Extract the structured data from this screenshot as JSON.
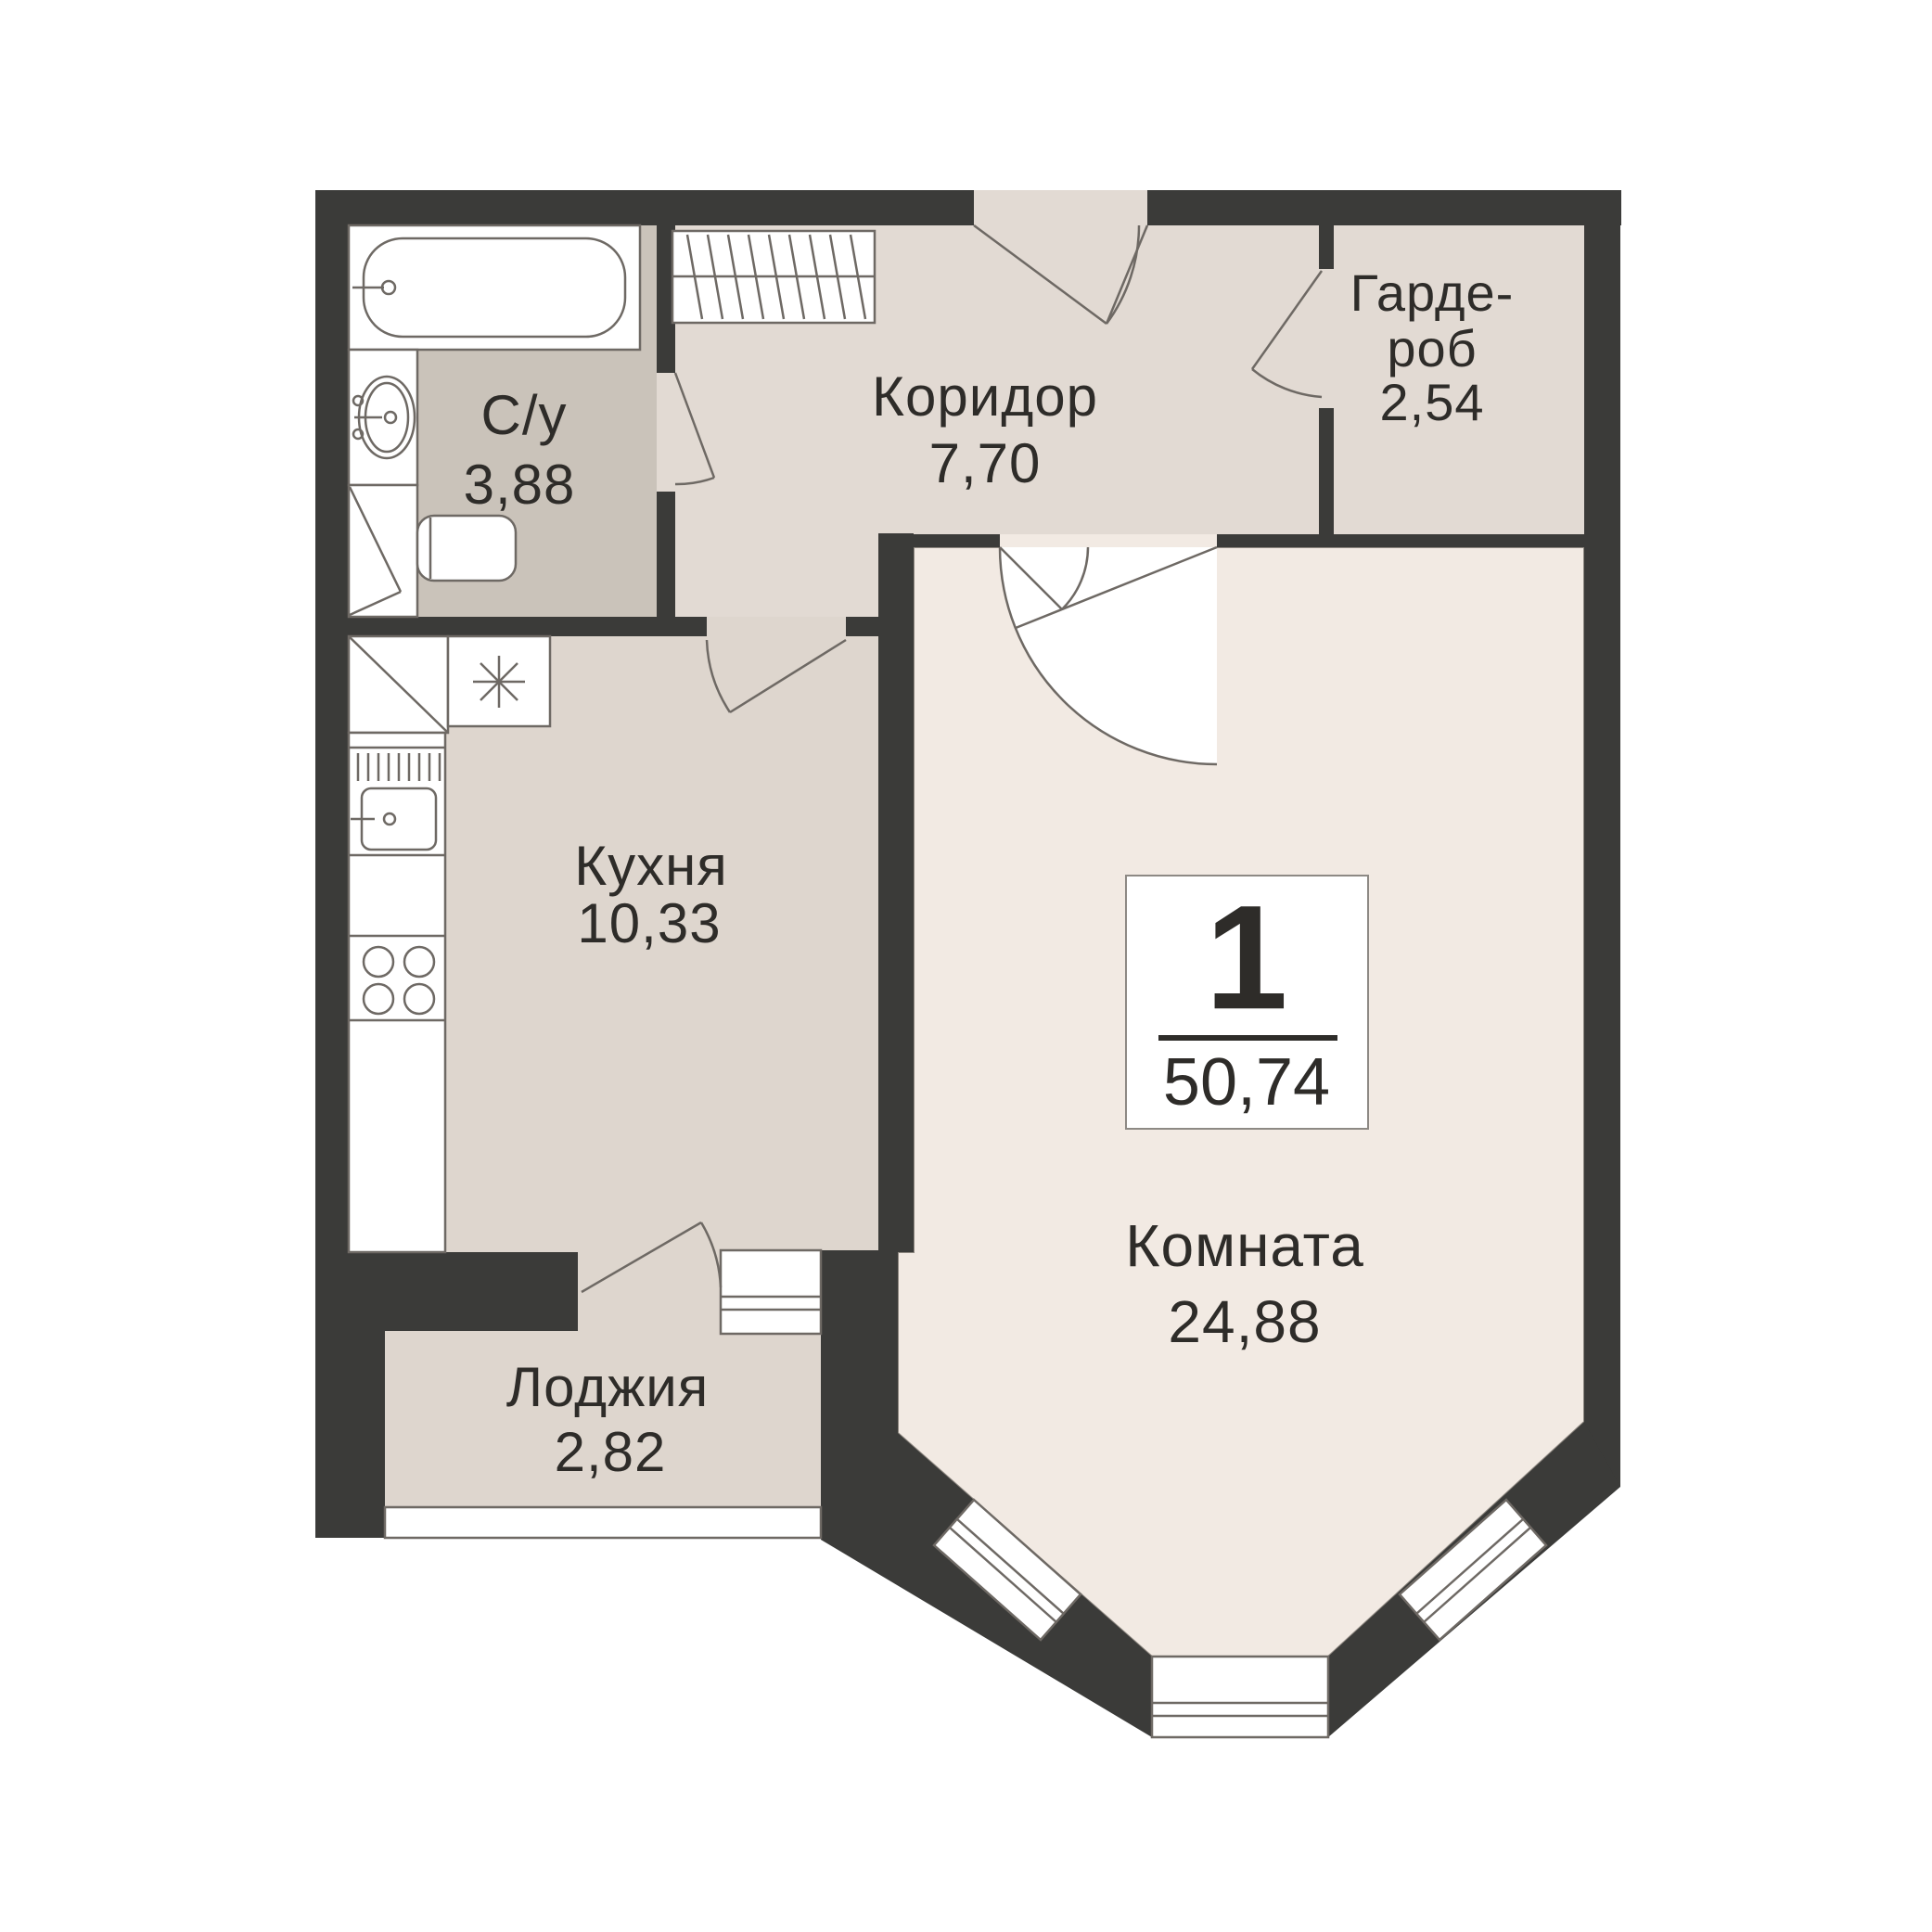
{
  "plan": {
    "type": "apartment-floor-plan",
    "language": "ru",
    "badge": {
      "rooms_count": "1",
      "total_area": "50,74"
    },
    "rooms": [
      {
        "id": "bathroom",
        "name": "С/у",
        "area": "3,88"
      },
      {
        "id": "corridor",
        "name": "Коридор",
        "area": "7,70"
      },
      {
        "id": "wardrobe",
        "name": "Гардероб",
        "line1": "Гарде-",
        "line2": "роб",
        "area": "2,54"
      },
      {
        "id": "kitchen",
        "name": "Кухня",
        "area": "10,33"
      },
      {
        "id": "room",
        "name": "Комната",
        "area": "24,88"
      },
      {
        "id": "loggia",
        "name": "Лоджия",
        "area": "2,82"
      }
    ],
    "colors": {
      "wall": "#3b3b39",
      "line": "#6e6964",
      "fixture": "#ffffff",
      "room_floor": "#f2eae3",
      "corridor_floor": "#e2dad3",
      "wardrobe_floor": "#e2dad3",
      "kitchen_floor": "#ded6ce",
      "loggia_floor": "#ded6ce",
      "bathroom_floor": "#cac3ba",
      "badge_border": "#8d8984",
      "text": "#2e2c29"
    }
  }
}
